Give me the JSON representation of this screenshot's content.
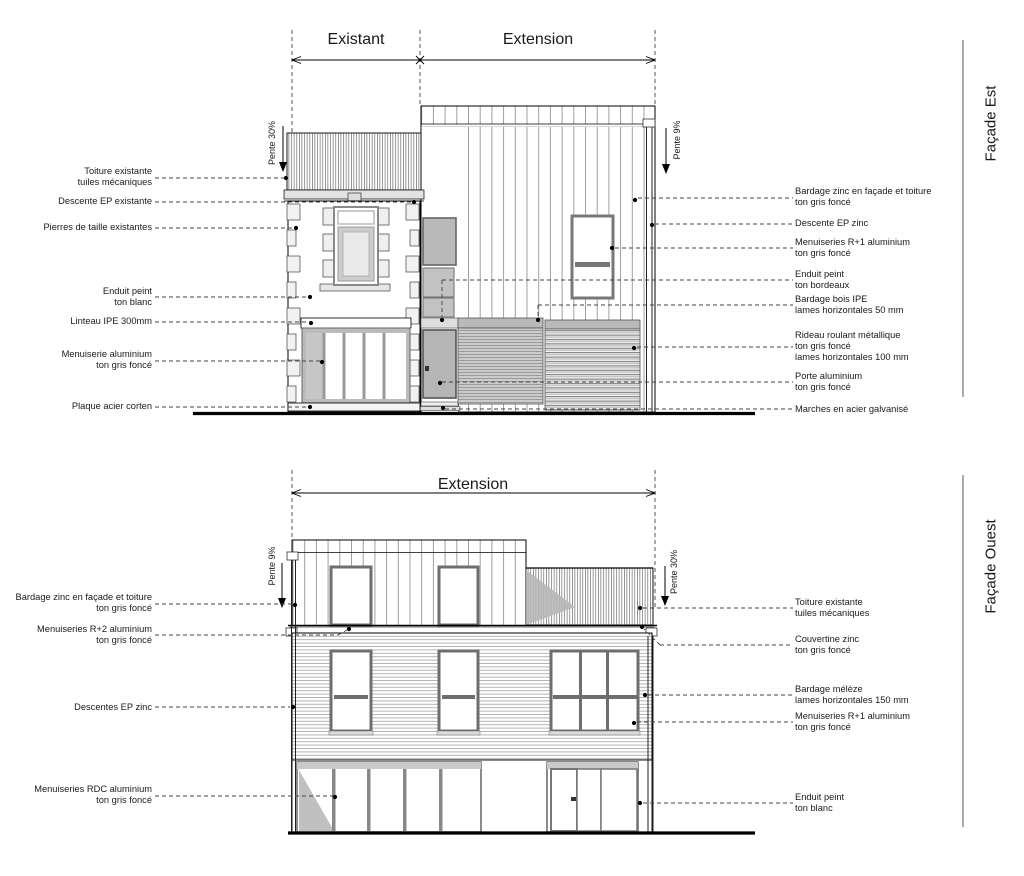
{
  "sheet": {
    "colors": {
      "line": "#000000",
      "text": "#1a1a1a",
      "gray_fill": "#c4c4c4"
    }
  },
  "facade_est": {
    "side_title": "Façade Est",
    "dim_labels": {
      "existant": "Existant",
      "extension": "Extension"
    },
    "pente_left": "Pente 30%",
    "pente_right": "Pente 9%",
    "labels_left": [
      {
        "text": "Toiture existante\ntuiles mécaniques"
      },
      {
        "text": "Descente EP existante"
      },
      {
        "text": "Pierres de taille existantes"
      },
      {
        "text": "Enduit peint\nton blanc"
      },
      {
        "text": "Linteau IPE 300mm"
      },
      {
        "text": "Menuiserie aluminium\nton gris foncé"
      },
      {
        "text": "Plaque acier corten"
      }
    ],
    "labels_right": [
      {
        "text": "Bardage zinc en façade et toiture\nton gris foncé"
      },
      {
        "text": "Descente EP zinc"
      },
      {
        "text": "Menuiseries R+1 aluminium\nton gris foncé"
      },
      {
        "text": "Enduit peint\nton bordeaux"
      },
      {
        "text": "Bardage bois IPE\nlames horizontales 50 mm"
      },
      {
        "text": "Rideau roulant métallique\nton gris foncé\nlames horizontales 100 mm"
      },
      {
        "text": "Porte aluminium\nton gris foncé"
      },
      {
        "text": "Marches en acier galvanisé"
      }
    ]
  },
  "facade_ouest": {
    "side_title": "Façade Ouest",
    "dim_labels": {
      "extension": "Extension"
    },
    "pente_left": "Pente 9%",
    "pente_right": "Pente 30%",
    "labels_left": [
      {
        "text": "Bardage zinc en façade et toiture\nton gris foncé"
      },
      {
        "text": "Menuiseries R+2 aluminium\nton gris foncé"
      },
      {
        "text": "Descentes EP zinc"
      },
      {
        "text": "Menuiseries RDC aluminium\nton gris foncé"
      }
    ],
    "labels_right": [
      {
        "text": "Toiture existante\ntuiles mécaniques"
      },
      {
        "text": "Couvertine zinc\nton gris foncé"
      },
      {
        "text": "Bardage mélèze\nlames horizontales 150 mm"
      },
      {
        "text": "Menuiseries R+1 aluminium\nton gris foncé"
      },
      {
        "text": "Enduit peint\nton blanc"
      }
    ]
  }
}
